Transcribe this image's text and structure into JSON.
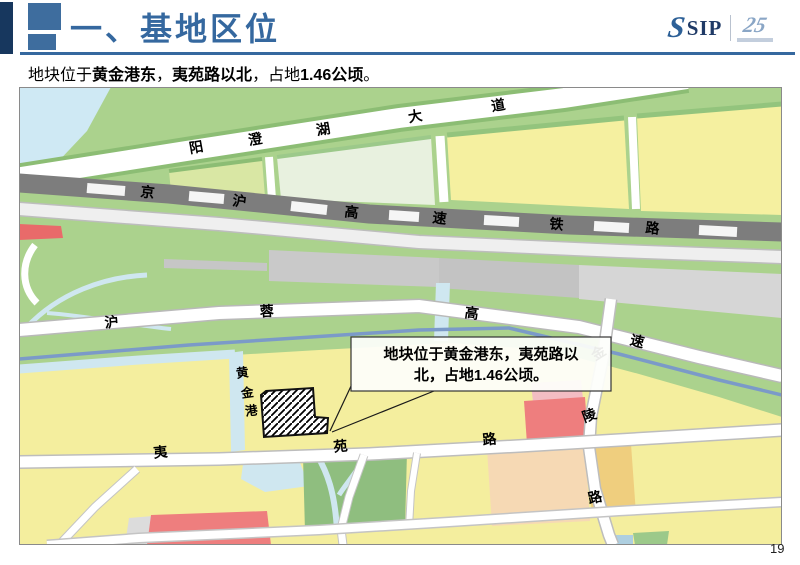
{
  "header": {
    "title": "一、基地区位",
    "logo": {
      "s_glyph": "S",
      "sip": "SIP",
      "badge": "25"
    }
  },
  "subtitle": {
    "segments": [
      {
        "t": "地块位于"
      },
      {
        "t": "黄金港东"
      },
      {
        "t": "，"
      },
      {
        "t": "夷苑路以北"
      },
      {
        "t": "，占地"
      },
      {
        "t": "1.46公顷"
      },
      {
        "t": "。"
      }
    ]
  },
  "map": {
    "roads": {
      "yangchenghu": "阳澄湖大道",
      "jinghu": "京沪高速铁路",
      "hurong": "沪蓉高速",
      "jinling": "金陵路",
      "yiyuan": "夷苑路"
    },
    "waterway": "黄金港",
    "callout": {
      "lines": [
        "地块位于黄金港东，夷苑路以",
        "北，占地1.46公顷。"
      ]
    }
  },
  "page_number": "19",
  "colors": {
    "accent_blue": "#35689f",
    "navy": "#17375e",
    "map_yellow": "#f4ee9e",
    "map_green": "#abd28d",
    "water_blue": "#cfe9f4",
    "railway_gray": "#7d7d7d",
    "parcel_red": "#ee7e7e"
  }
}
